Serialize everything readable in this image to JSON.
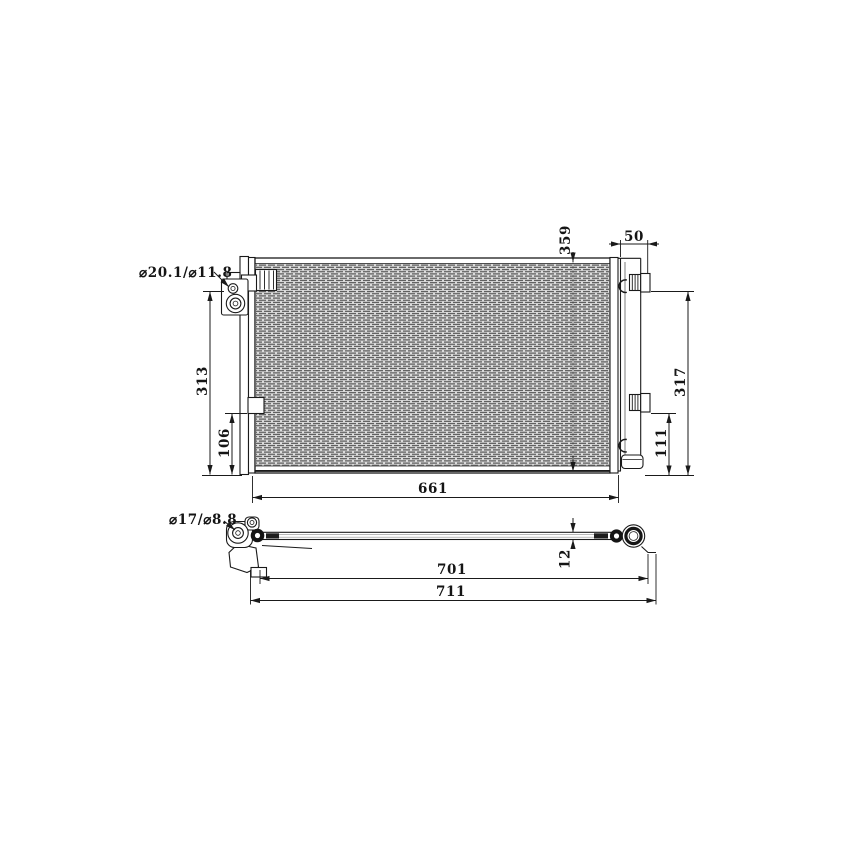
{
  "front_view": {
    "port_label": "⌀20.1/⌀11.8",
    "core_height": "359",
    "drier_offset": "50",
    "left_height": "313",
    "left_lower_height": "106",
    "right_height": "317",
    "right_lower_height": "111",
    "core_width": "661"
  },
  "side_view": {
    "port_label": "⌀17/⌀8.8",
    "thickness": "12",
    "length_mounting": "701",
    "length_overall": "711"
  },
  "colors": {
    "line": "#1a1a1a",
    "fin_dark": "#585858",
    "fin_light": "#dcdcdc",
    "background": "#ffffff"
  }
}
